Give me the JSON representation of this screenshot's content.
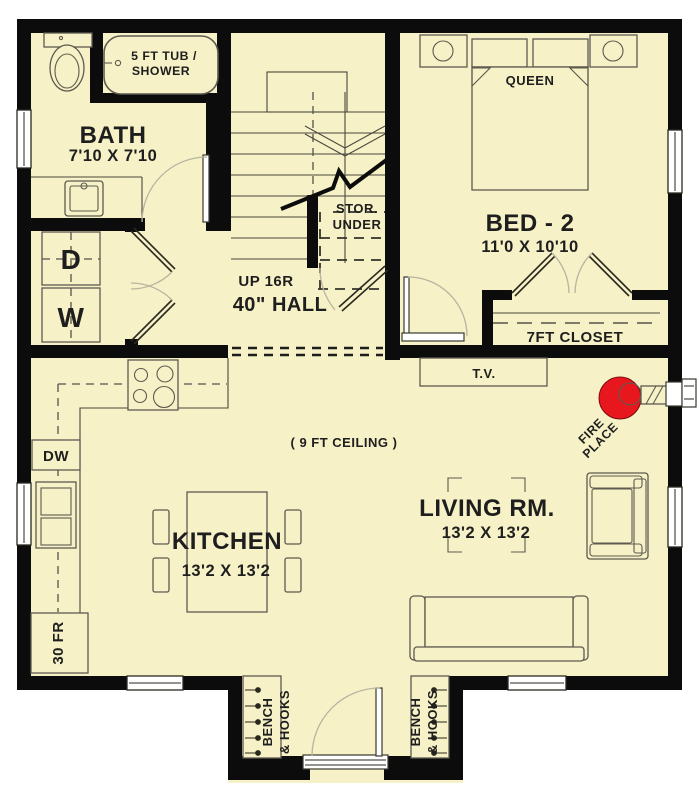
{
  "title": "First floor plan",
  "colors": {
    "floor": "#f6f1c6",
    "wall": "#0c0c0c",
    "line": "#4a473f",
    "arc": "#b9b4a0",
    "fireplace_red": "#e8171e",
    "white": "#ffffff",
    "text": "#1e1e1e"
  },
  "labels": {
    "bath": {
      "name": "BATH",
      "dims": "7'10 X 7'10"
    },
    "tub": {
      "line1": "5 FT TUB /",
      "line2": "SHOWER"
    },
    "laundry": {
      "dryer": "D",
      "washer": "W"
    },
    "stairs": {
      "up": "UP 16R",
      "stor1": "STOR.",
      "stor2": "UNDER"
    },
    "hall": {
      "name": "40\" HALL"
    },
    "bed2": {
      "name": "BED - 2",
      "dims": "11'0 X 10'10",
      "bed": "QUEEN",
      "closet": "7FT CLOSET"
    },
    "living": {
      "name": "LIVING RM.",
      "dims": "13'2 X 13'2",
      "tv": "T.V.",
      "ceiling": "( 9 FT CEILING )"
    },
    "fireplace": {
      "line1": "FIRE",
      "line2": "PLACE"
    },
    "kitchen": {
      "name": "KITCHEN",
      "dims": "13'2 X 13'2",
      "dishwasher": "DW",
      "fridge": "30 FR"
    },
    "entry": {
      "bench_line1": "BENCH",
      "bench_line2": "& HOOKS"
    }
  }
}
